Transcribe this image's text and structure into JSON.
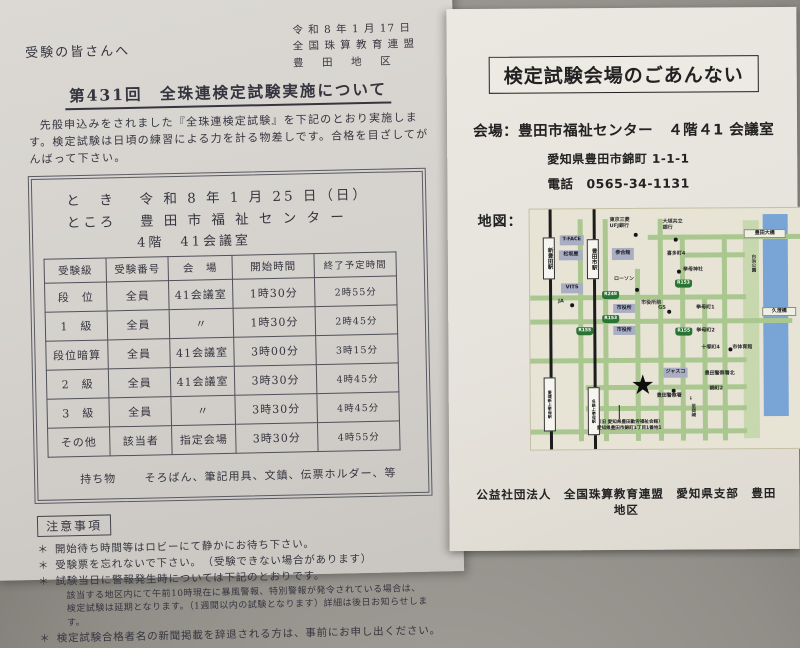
{
  "left_page": {
    "salutation": "受験の皆さんへ",
    "date_line": "令 和 8 年 1 月 17 日",
    "org_line": "全 国 珠 算 教 育 連 盟",
    "district_line": "豊　田　地　区",
    "title": "第431回　全珠連検定試験実施について",
    "intro": "先般申込みをされました『全珠連検定試験』を下記のとおり実施します。検定試験は日頃の練習による力を計る物差しです。合格を目ざしてがんばって下さい。",
    "when_label": "と　き",
    "when_value": "令 和 8 年 1 月 25 日（日）",
    "where_label": "ところ",
    "where_value": "豊 田 市 福 祉 セ ン タ ー",
    "where_room": "4階　41会議室",
    "table": {
      "headers": [
        "受験級",
        "受験番号",
        "会　場",
        "開始時間",
        "終了予定時間"
      ],
      "rows": [
        [
          "段　位",
          "全員",
          "41会議室",
          "1時30分",
          "2時55分"
        ],
        [
          "1　級",
          "全員",
          "〃",
          "1時30分",
          "2時45分"
        ],
        [
          "段位暗算",
          "全員",
          "41会議室",
          "3時00分",
          "3時15分"
        ],
        [
          "2　級",
          "全員",
          "41会議室",
          "3時30分",
          "4時45分"
        ],
        [
          "3　級",
          "全員",
          "〃",
          "3時30分",
          "4時45分"
        ],
        [
          "その他",
          "該当者",
          "指定会場",
          "3時30分",
          "4時55分"
        ]
      ]
    },
    "belongings_label": "持ち物",
    "belongings_value": "そろばん、筆記用具、文鎮、伝票ホルダー、等",
    "notes_title": "注意事項",
    "bullet": "＊",
    "notes": [
      "開始待ち時間等はロビーにて静かにお待ち下さい。",
      "受験票を忘れないで下さい。　（受験できない場合があります）",
      "試験当日に警報発生時については下記のとおりです。",
      "検定試験合格者名の新聞掲載を辞退される方は、事前にお申し出ください。"
    ],
    "note3_subs": [
      "該当する地区内にて午前10時現在に暴風警報、特別警報が発令されている場合は、",
      "検定試験は延期となります。（1週間以内の試験となります）詳細は後日お知らせします。"
    ]
  },
  "right_page": {
    "title": "検定試験会場のごあんない",
    "venue_label": "会場：",
    "venue_value": "豊田市福祉センター　４階４1 会議室",
    "venue_address": "愛知県豊田市錦町 1-1-1",
    "tel_label": "電話",
    "tel_value": "0565-34-1131",
    "map_label": "地図：",
    "footer": "公益社団法人　全国珠算教育連盟　愛知県支部　豊田地区",
    "map": {
      "elements": [
        {
          "t": "park",
          "x": 213,
          "y": 12,
          "w": 16,
          "h": 218,
          "n": "shirahama-park-strip"
        },
        {
          "t": "river",
          "x": 233,
          "y": 6,
          "w": 25,
          "h": 202,
          "n": "river-strip"
        },
        {
          "t": "roadh",
          "x": 118,
          "y": 26,
          "w": 170,
          "h": 5,
          "n": "road-h1"
        },
        {
          "t": "roadh",
          "x": 150,
          "y": 44,
          "w": 65,
          "h": 5,
          "n": "road-h2"
        },
        {
          "t": "roadh",
          "x": 0,
          "y": 86,
          "w": 216,
          "h": 5,
          "n": "road-h3"
        },
        {
          "t": "roadh",
          "x": 0,
          "y": 110,
          "w": 262,
          "h": 5,
          "n": "road-h4"
        },
        {
          "t": "roadh",
          "x": 0,
          "y": 149,
          "w": 216,
          "h": 5,
          "n": "road-h5"
        },
        {
          "t": "roadh",
          "x": 55,
          "y": 176,
          "w": 161,
          "h": 5,
          "n": "road-h6"
        },
        {
          "t": "roadh",
          "x": 55,
          "y": 197,
          "w": 161,
          "h": 5,
          "n": "road-h7"
        },
        {
          "t": "roadh",
          "x": 0,
          "y": 220,
          "w": 216,
          "h": 5,
          "n": "road-h8"
        },
        {
          "t": "roadv",
          "x": 48,
          "y": 10,
          "w": 5,
          "h": 222,
          "n": "road-v1"
        },
        {
          "t": "roadv",
          "x": 73,
          "y": 10,
          "w": 5,
          "h": 222,
          "n": "road-v2"
        },
        {
          "t": "roadv",
          "x": 105,
          "y": 60,
          "w": 5,
          "h": 172,
          "n": "road-v3"
        },
        {
          "t": "roadv",
          "x": 128,
          "y": 10,
          "w": 5,
          "h": 222,
          "n": "road-v4"
        },
        {
          "t": "roadv",
          "x": 150,
          "y": 26,
          "w": 5,
          "h": 206,
          "n": "road-v5"
        },
        {
          "t": "roadv",
          "x": 172,
          "y": 86,
          "w": 5,
          "h": 146,
          "n": "road-v6"
        },
        {
          "t": "roadv",
          "x": 192,
          "y": 26,
          "w": 5,
          "h": 206,
          "n": "road-v7"
        },
        {
          "t": "rail",
          "x": 19,
          "y": 0,
          "w": 3,
          "h": 240,
          "n": "railway-line-west"
        },
        {
          "t": "rail",
          "x": 63,
          "y": 0,
          "w": 3,
          "h": 240,
          "n": "railway-line-east"
        },
        {
          "t": "station",
          "x": 13,
          "y": 28,
          "w": 12,
          "h": 42,
          "text": "新豊田駅",
          "n": "station-shin-toyota"
        },
        {
          "t": "station",
          "x": 57,
          "y": 30,
          "w": 12,
          "h": 40,
          "text": "豊田市駅",
          "n": "station-toyotashi"
        },
        {
          "t": "station",
          "x": 13,
          "y": 168,
          "w": 12,
          "h": 54,
          "text": "愛環新上挙母駅",
          "fs": 4,
          "n": "station-aikan-shin-uwagoromo"
        },
        {
          "t": "station",
          "x": 57,
          "y": 178,
          "w": 12,
          "h": 48,
          "text": "名鉄上挙母駅",
          "fs": 4,
          "n": "station-meitetsu-uwagoromo"
        },
        {
          "t": "bridge",
          "x": 214,
          "y": 21,
          "w": 42,
          "h": 9,
          "text": "豊田大橋",
          "n": "bridge-toyota-ohashi"
        },
        {
          "t": "bridge",
          "x": 232,
          "y": 99,
          "w": 34,
          "h": 9,
          "text": "久澄橋",
          "n": "bridge-kyuzumi"
        },
        {
          "t": "label",
          "x": 215,
          "y": 46,
          "w": 10,
          "h": 34,
          "text": "白浜公園",
          "v": 1,
          "fs": 4.5,
          "n": "label-shirahama-park"
        },
        {
          "t": "box",
          "x": 30,
          "y": 26,
          "w": 24,
          "h": 10,
          "text": "T-FACE",
          "n": "building-t-face"
        },
        {
          "t": "box",
          "x": 29,
          "y": 41,
          "w": 24,
          "h": 10,
          "text": "松坂屋",
          "n": "building-matsuzakaya"
        },
        {
          "t": "box",
          "x": 82,
          "y": 39,
          "w": 22,
          "h": 12,
          "text": "参合館",
          "n": "building-sangokan"
        },
        {
          "t": "box",
          "x": 31,
          "y": 74,
          "w": 22,
          "h": 10,
          "text": "VITS",
          "n": "building-vits"
        },
        {
          "t": "box",
          "x": 83,
          "y": 95,
          "w": 22,
          "h": 9,
          "text": "市役所",
          "n": "building-city-hall-1"
        },
        {
          "t": "box",
          "x": 83,
          "y": 117,
          "w": 22,
          "h": 9,
          "text": "市役所",
          "n": "building-city-hall-2"
        },
        {
          "t": "box",
          "x": 133,
          "y": 159,
          "w": 24,
          "h": 10,
          "text": "ジャスコ",
          "n": "building-jusco"
        },
        {
          "t": "label",
          "x": 80,
          "y": 9,
          "text": "東京三菱",
          "n": "label-bank-tokyo-mitsubishi-line1"
        },
        {
          "t": "label",
          "x": 80,
          "y": 15,
          "text": "UFJ銀行",
          "n": "label-bank-tokyo-mitsubishi-line2"
        },
        {
          "t": "label",
          "x": 133,
          "y": 11,
          "text": "大垣共立",
          "n": "label-bank-ogaki-kyoritsu-line1"
        },
        {
          "t": "label",
          "x": 133,
          "y": 17,
          "text": "銀行",
          "n": "label-bank-ogaki-kyoritsu-line2"
        },
        {
          "t": "label",
          "x": 84,
          "y": 68,
          "text": "ローソン",
          "n": "label-lawson"
        },
        {
          "t": "label",
          "x": 28,
          "y": 90,
          "text": "JA",
          "n": "label-ja"
        },
        {
          "t": "label",
          "x": 128,
          "y": 97,
          "text": "GS",
          "n": "label-gs"
        },
        {
          "t": "label",
          "x": 153,
          "y": 59,
          "text": "挙母神社",
          "n": "label-koromo-shrine"
        },
        {
          "t": "label",
          "x": 202,
          "y": 137,
          "text": "市体育館",
          "n": "label-city-gymnasium"
        },
        {
          "t": "label",
          "x": 126,
          "y": 185,
          "text": "豊田警察署",
          "n": "label-toyota-police-station"
        },
        {
          "t": "label",
          "x": 174,
          "y": 163,
          "text": "豊田警察署北",
          "n": "label-police-station-north"
        },
        {
          "t": "label",
          "x": 137,
          "y": 43,
          "text": "喜多町4",
          "n": "label-kitamachi-4"
        },
        {
          "t": "label",
          "x": 166,
          "y": 97,
          "text": "挙母町1",
          "n": "label-koromocho-1"
        },
        {
          "t": "label",
          "x": 166,
          "y": 120,
          "text": "挙母町2",
          "n": "label-koromocho-2"
        },
        {
          "t": "label",
          "x": 171,
          "y": 137,
          "text": "十塚町4",
          "n": "label-totsukacho-4"
        },
        {
          "t": "label",
          "x": 179,
          "y": 178,
          "text": "錦町2",
          "n": "label-nishikicho-2"
        },
        {
          "t": "label",
          "x": 111,
          "y": 92,
          "text": "市役所前",
          "n": "label-city-hall-mae"
        },
        {
          "t": "dot",
          "x": 104,
          "y": 24,
          "n": "dot-bank-ufj"
        },
        {
          "t": "dot",
          "x": 144,
          "y": 29,
          "n": "dot-bank-ogaki"
        },
        {
          "t": "dot",
          "x": 105,
          "y": 79,
          "n": "dot-lawson"
        },
        {
          "t": "dot",
          "x": 40,
          "y": 94,
          "n": "dot-ja"
        },
        {
          "t": "dot",
          "x": 137,
          "y": 101,
          "n": "dot-gs"
        },
        {
          "t": "dot",
          "x": 147,
          "y": 61,
          "n": "dot-koromo-shrine"
        },
        {
          "t": "dot",
          "x": 198,
          "y": 139,
          "n": "dot-city-gym"
        },
        {
          "t": "dot",
          "x": 141,
          "y": 180,
          "n": "dot-police-station"
        },
        {
          "t": "badge",
          "x": 72,
          "y": 82,
          "text": "R248",
          "n": "route-badge-248"
        },
        {
          "t": "badge",
          "x": 72,
          "y": 106,
          "text": "R153",
          "n": "route-badge-153-a"
        },
        {
          "t": "badge",
          "x": 145,
          "y": 71,
          "text": "R153",
          "n": "route-badge-153-b"
        },
        {
          "t": "badge",
          "x": 46,
          "y": 118,
          "text": "R155",
          "n": "route-badge-155-a"
        },
        {
          "t": "badge",
          "x": 145,
          "y": 119,
          "text": "R155",
          "n": "route-badge-155-b"
        },
        {
          "t": "star",
          "x": 100,
          "y": 165,
          "text": "★",
          "n": "venue-star-marker"
        },
        {
          "t": "vline",
          "x": 88,
          "y": 196,
          "h": 14,
          "n": "star-leader-line"
        },
        {
          "t": "caption",
          "x": 66,
          "y": 211,
          "text": "（旧 愛知県豊田勤労福祉会館）",
          "n": "venue-caption-former-name"
        },
        {
          "t": "caption",
          "x": 66,
          "y": 217,
          "text": "愛知県豊田市錦町1丁目1番地1",
          "n": "venue-caption-address"
        },
        {
          "t": "label",
          "x": 158,
          "y": 188,
          "text": "↓",
          "n": "arrow-south-icon"
        },
        {
          "t": "label",
          "x": 156,
          "y": 195,
          "w": 8,
          "h": 24,
          "text": "至岡崎",
          "v": 1,
          "fs": 4.5,
          "n": "label-to-okazaki"
        }
      ]
    }
  }
}
